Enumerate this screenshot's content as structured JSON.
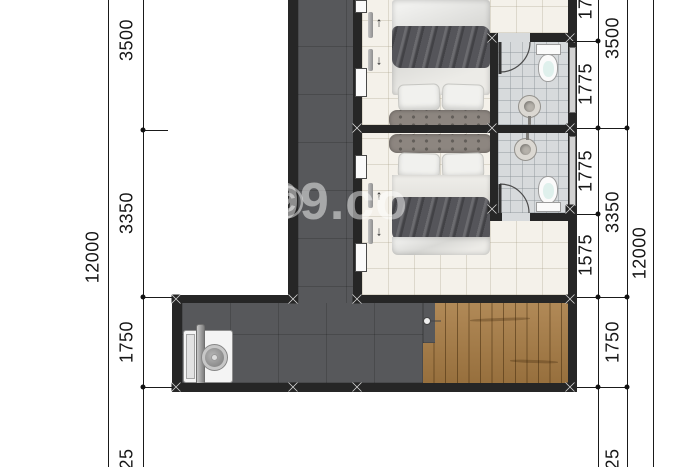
{
  "watermark": {
    "copyright_symbol": "©",
    "brand": "99.co"
  },
  "dimensions": {
    "left_total": "12000",
    "right_total": "12000",
    "left_segments": [
      "3500",
      "3350",
      "1750",
      "25"
    ],
    "right_inner_segments": [
      "17",
      "1775",
      "1775",
      "1575"
    ],
    "right_outer_segments": [
      "3500",
      "3350",
      "1750",
      "25"
    ]
  },
  "plan": {
    "arrows": {
      "up": "↑",
      "down": "↓"
    },
    "icons": [
      "double-bed",
      "headboard",
      "pillow",
      "toilet",
      "pedestal-sink",
      "door-swing-arc",
      "sliding-door-panel",
      "window",
      "washing-machine",
      "staircase",
      "column-marker"
    ],
    "colors": {
      "wall": "#262626",
      "floor_dark": "#57585b",
      "floor_bedroom": "#f4f1ea",
      "floor_bathroom": "#d7dadc",
      "stairs_wood": "#a87c44",
      "dimension_line": "#1a1a1a"
    }
  }
}
